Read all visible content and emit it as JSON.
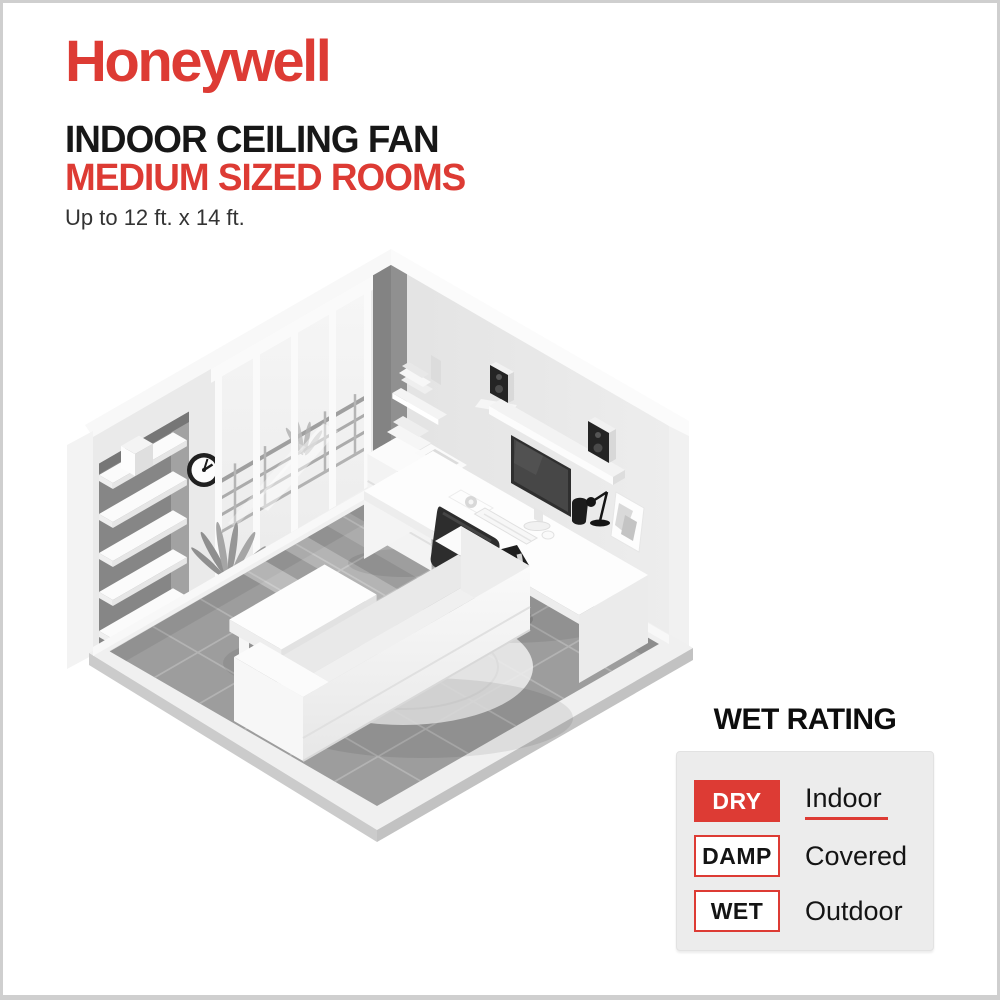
{
  "brand": {
    "logo": "Honeywell"
  },
  "header": {
    "title_line1": "INDOOR CEILING FAN",
    "title_line2": "MEDIUM SIZED ROOMS",
    "subtitle": "Up to 12 ft. x 14 ft."
  },
  "wet_rating": {
    "heading": "WET RATING",
    "rows": [
      {
        "badge": "DRY",
        "label": "Indoor",
        "active": true
      },
      {
        "badge": "DAMP",
        "label": "Covered",
        "active": false
      },
      {
        "badge": "WET",
        "label": "Outdoor",
        "active": false
      }
    ]
  },
  "theme": {
    "accent-red": "#dd3b34",
    "text-black": "#171717",
    "panel-gray": "#ececec",
    "border-gray": "#cfcfcf"
  }
}
